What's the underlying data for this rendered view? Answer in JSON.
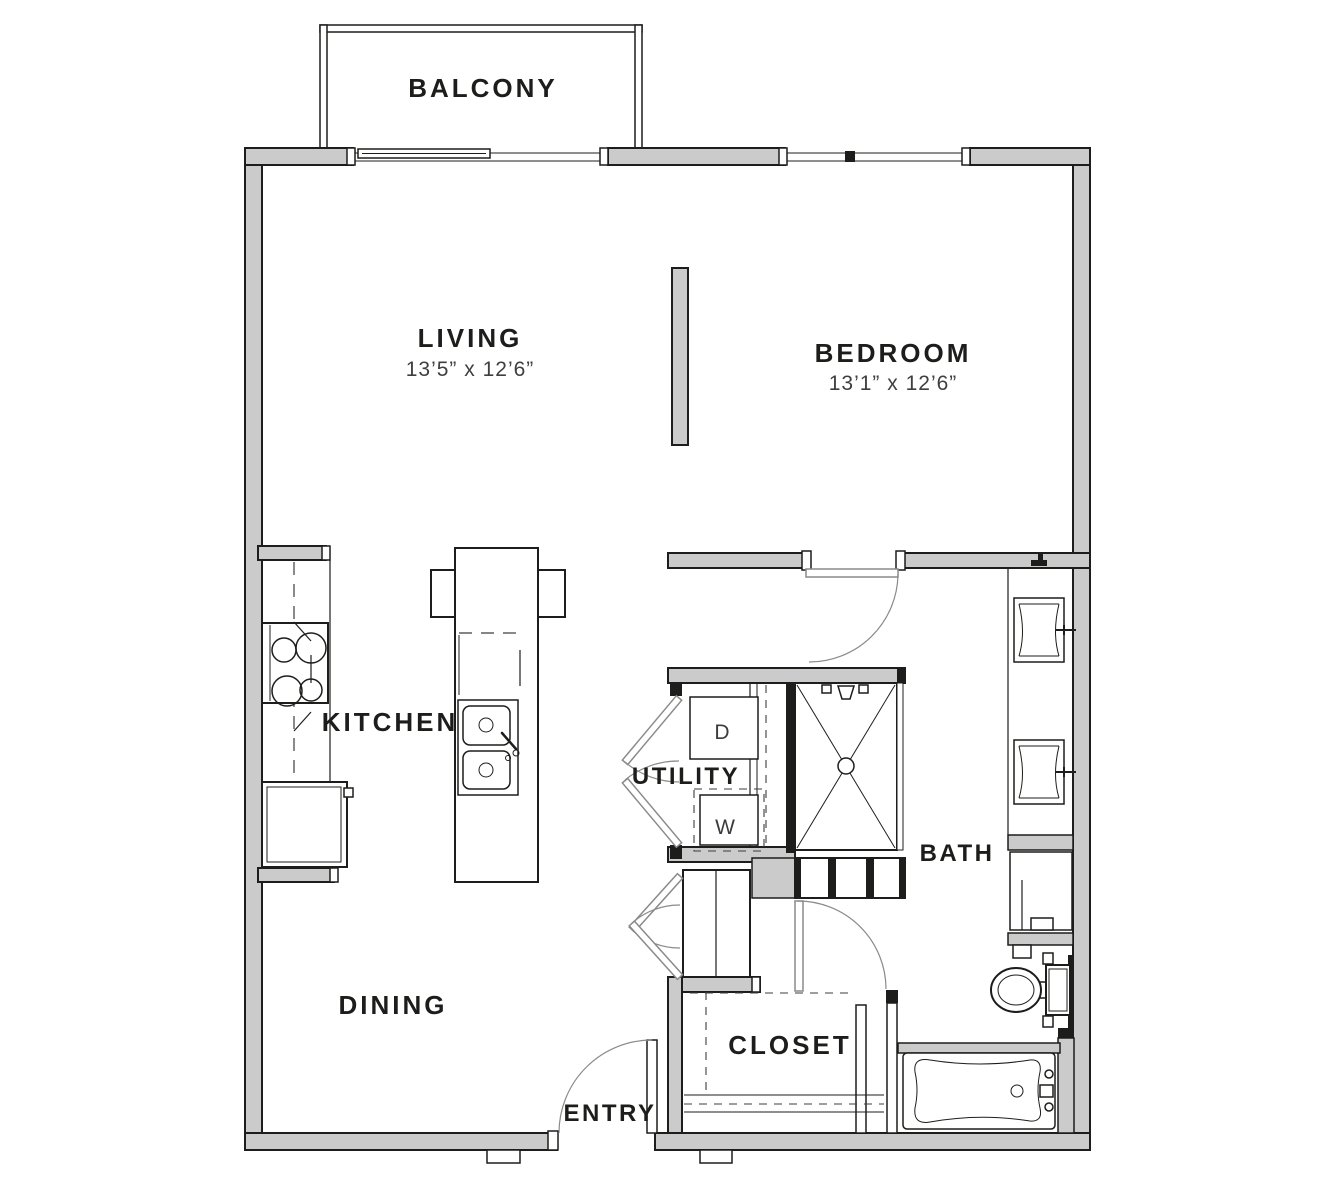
{
  "rooms": {
    "balcony": {
      "label": "BALCONY"
    },
    "living": {
      "label": "LIVING",
      "dimensions": "13’5” x 12’6”"
    },
    "bedroom": {
      "label": "BEDROOM",
      "dimensions": "13’1” x 12’6”"
    },
    "kitchen": {
      "label": "KITCHEN"
    },
    "utility": {
      "label": "UTILITY"
    },
    "bath": {
      "label": "BATH"
    },
    "dining": {
      "label": "DINING"
    },
    "closet": {
      "label": "CLOSET"
    },
    "entry": {
      "label": "ENTRY"
    }
  },
  "appliances": {
    "dryer_label": "D",
    "washer_label": "W"
  },
  "colors": {
    "wall_fill": "#cbcbcb",
    "line": "#1d1d1b",
    "dim_text": "#3f3f3f",
    "background": "#ffffff"
  }
}
